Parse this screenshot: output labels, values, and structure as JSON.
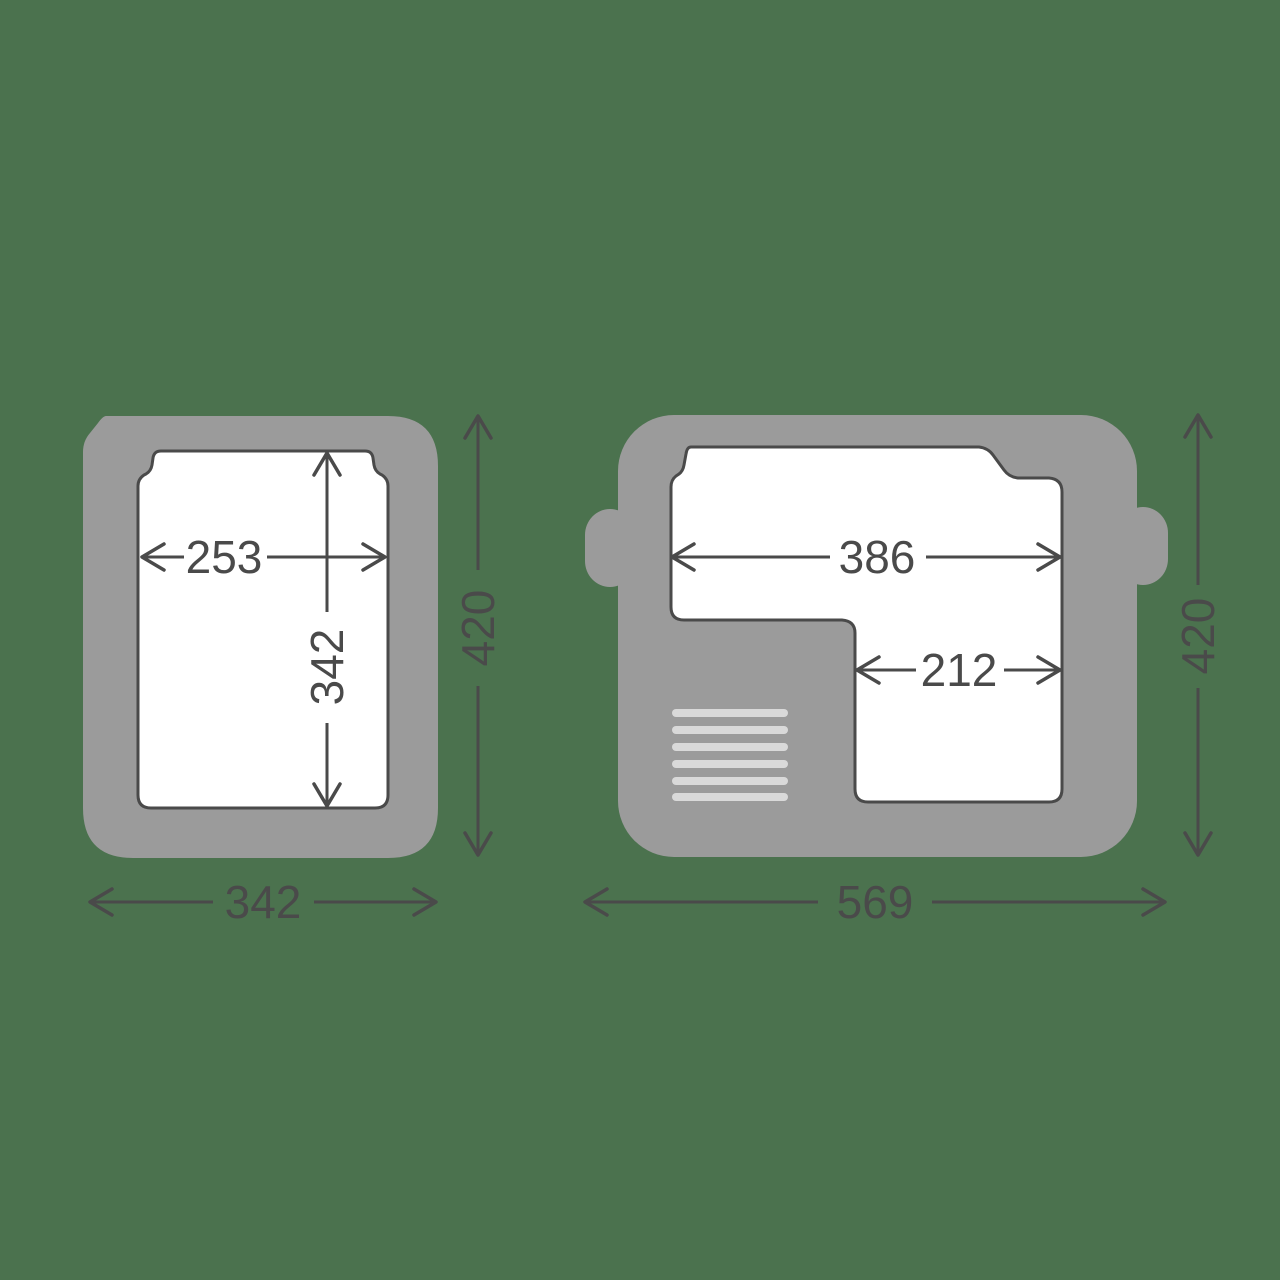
{
  "diagram": {
    "title": "cooler-top-and-side-dimension-drawing",
    "left_view": {
      "inner_width_mm": "253",
      "inner_depth_mm": "342",
      "overall_height_mm": "420",
      "overall_width_mm": "342"
    },
    "right_view": {
      "upper_inner_width_mm": "386",
      "lower_inner_width_mm": "212",
      "overall_height_mm": "420",
      "overall_width_mm": "569"
    }
  },
  "colors": {
    "background": "#4B724E",
    "body_gray": "#9B9B9B",
    "inner_white": "#FFFFFF",
    "outline_dark": "#4A4A4A",
    "vent_light": "#D9D9D9"
  }
}
